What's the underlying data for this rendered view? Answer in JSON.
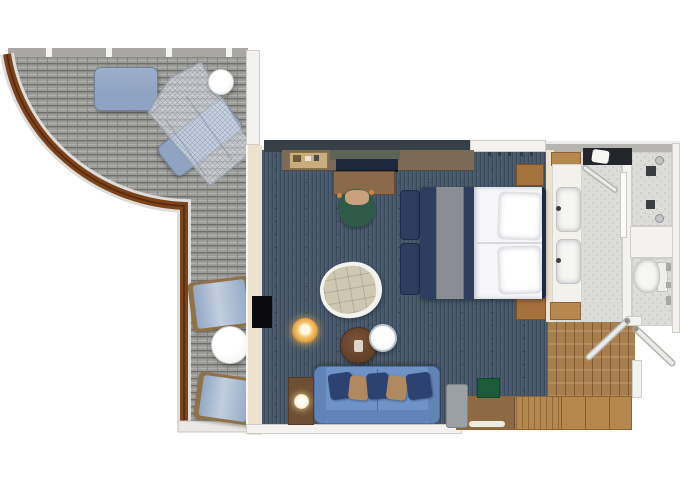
{
  "meta": {
    "title": "Cruise ship suite floor plan"
  },
  "legend": {
    "rooms": [
      "balcony",
      "bedroom-living-area",
      "bathroom-corridor",
      "shower-room",
      "toilet-room",
      "entry-hall"
    ],
    "balcony_items": [
      "sun-lounger",
      "net-canopy-lounger",
      "round-table",
      "deck-chair",
      "round-table",
      "deck-chair",
      "curved-wood-railing"
    ],
    "cabin_items": [
      "minibar-tray",
      "desk",
      "desk-chair",
      "desk-tv-panel",
      "king-bed",
      "foot-benches",
      "nightstands",
      "swivel-armchair",
      "amber-stool",
      "coffee-table",
      "white-side-table",
      "sofa",
      "lamp-side-table",
      "wall-tv",
      "green-bench",
      "gray-stool",
      "dresser",
      "wardrobes"
    ],
    "bathroom_items": [
      "towel-counter",
      "double-sink-vanity",
      "sliding-shower-door",
      "shower-controls",
      "toilet"
    ],
    "doors": [
      "hall-door-leaf",
      "entry-door-leaf",
      "bathroom-door-leaf"
    ]
  },
  "colors": {
    "bg": "#ffffff",
    "deck_plank": "#9c9c99",
    "deck_gap": "#6e6e6b",
    "deck_light": "#b1b1ae",
    "deck_wall": "#a8a7a3",
    "railing": "#7c431b",
    "railing_dark": "#53290c",
    "railing_edge": "#dedddb",
    "net_fill": "rgba(236,239,244,0.55)",
    "net_line": "#97a0ac",
    "lounger": "#8fa4c2",
    "lounger_edge": "#71819c",
    "dchair_pad": "#93a7c5",
    "dchair_frame": "#8f7248",
    "table_white_top": "#f4f6f8",
    "table_white_rim": "#cfcfca",
    "carpet": "#46586a",
    "wall_dark": "#373f47",
    "wall_cream": "#ece2cf",
    "wall_white": "#f3f2ee",
    "wall_gray": "#b6b5b1",
    "wall_edge": "#cfceca",
    "counter_wood": "#7b6a55",
    "tray": "#c9ad7c",
    "olive": "#5c6357",
    "tv_panel": "#1e293d",
    "tv_black": "#0b0b0d",
    "desk_wood": "#8a6a4a",
    "desk_edge": "#65492f",
    "chair_green": "#2f5a49",
    "chair_seat": "#c8a27e",
    "chair_knob": "#c78a3c",
    "bed_navy": "#2f3d60",
    "bed_runner": "#8a8d93",
    "bed_white": "#f6f6f8",
    "bed_head": "#1f2946",
    "pillow_edge": "#dcdce0",
    "nightstand": "#a5713d",
    "armchair_frame": "#f2f2ef",
    "armchair_cushion": "#cec7b1",
    "stool_core": "#fff7e0",
    "stool_ring": "#e8a33c",
    "ctable_brown": "#6b4830",
    "ctable_rim": "#4a3020",
    "ctable_obj": "#ded6c8",
    "stable_rim": "#b9c2cc",
    "sofa": "#6f93c7",
    "sofa_dark": "#6283b6",
    "sofa_edge": "#4d6fa3",
    "pillow_navy": "#2c4270",
    "pillow_tan": "#b08a5e",
    "sidetable": "#6f4f33",
    "lamp": "#fff3cf",
    "graychair": "#9aa0a3",
    "bench_green": "#1d5c38",
    "wardrobe": "#b5884e",
    "wardrobe_edge": "#8a6438",
    "dresser": "#8d6a42",
    "entry_floor": "#a87e4e",
    "tile": "#dcdcd9",
    "tile_dot": "#c6c6c2",
    "bath_counter": "#23262b",
    "fixture": "#f6f6f4",
    "fixture_edge": "#c5c5c0",
    "metal": "#8e9094",
    "control": "#3a3d42",
    "door_leaf": "#eceae6",
    "door_edge": "#b4b3af"
  }
}
